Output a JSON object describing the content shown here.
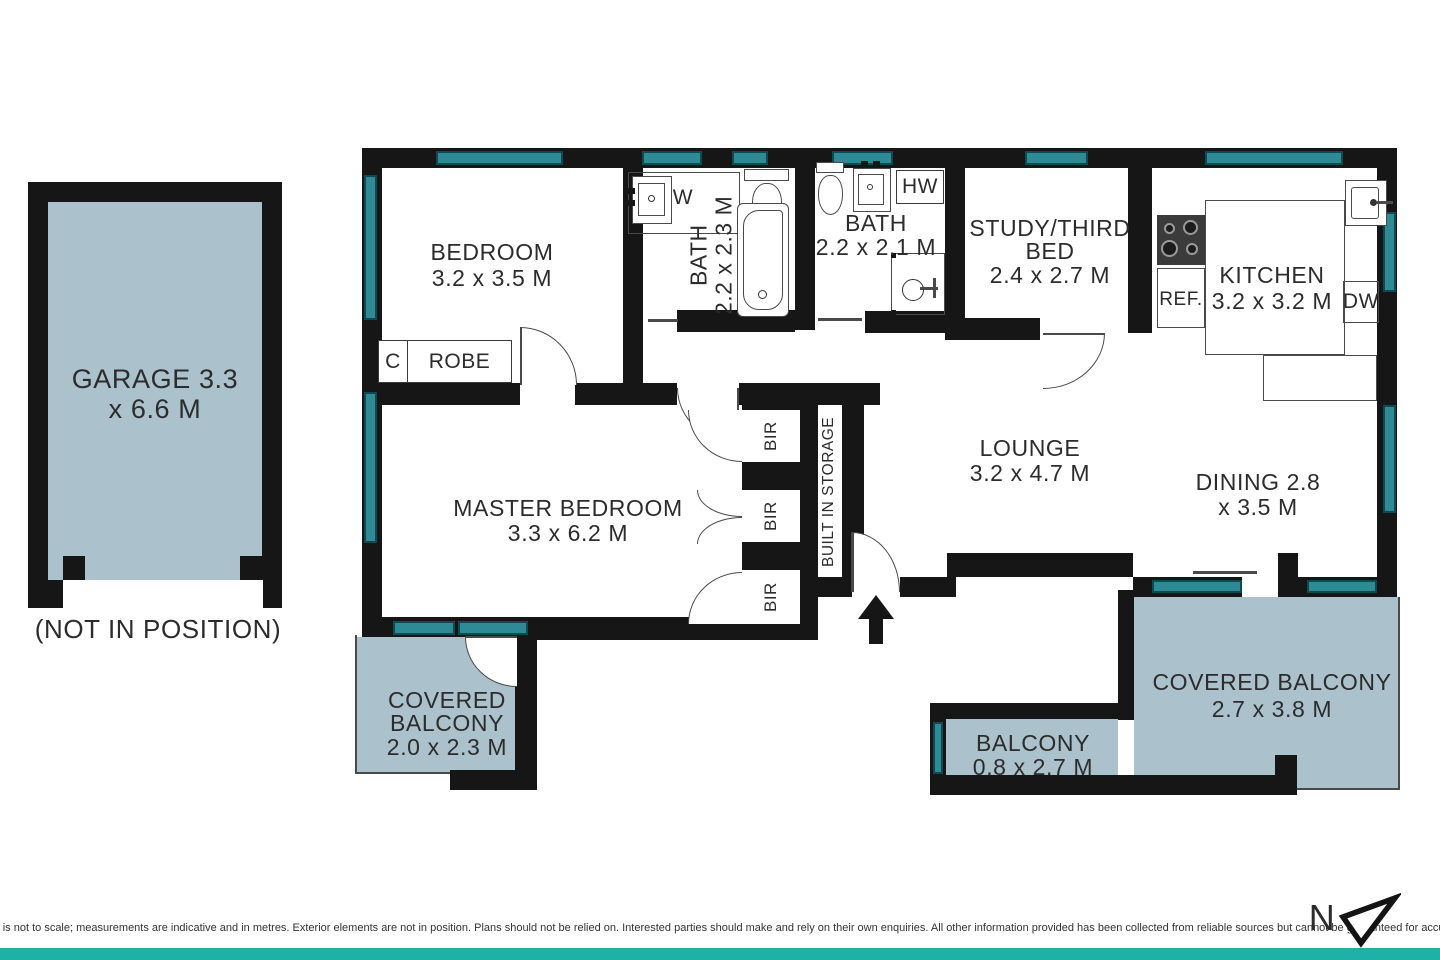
{
  "title": "Apartment floor plan",
  "colors": {
    "wall": "#161616",
    "window_teal": "#2e8a95",
    "window_border": "#0f4a52",
    "area_fill": "#abc1cb",
    "accent_bar": "#1eb2a6",
    "text": "#2c2c2c"
  },
  "garage": {
    "line1": "GARAGE 3.3",
    "line2": "x 6.6 M",
    "note": "(NOT IN POSITION)"
  },
  "rooms": {
    "bedroom": {
      "name": "BEDROOM",
      "dims": "3.2 x 3.5 M"
    },
    "bath1": {
      "name": "BATH",
      "dims": "2.2 x 2.3 M"
    },
    "bath2": {
      "name": "BATH",
      "dims": "2.2 x 2.1 M"
    },
    "study": {
      "line1": "STUDY/THIRD",
      "line2": "BED",
      "dims": "2.4 x 2.7 M"
    },
    "kitchen": {
      "name": "KITCHEN",
      "dims": "3.2 x 3.2 M"
    },
    "master": {
      "name": "MASTER BEDROOM",
      "dims": "3.3 x 6.2 M"
    },
    "lounge": {
      "name": "LOUNGE",
      "dims": "3.2 x 4.7 M"
    },
    "dining": {
      "line1": "DINING 2.8",
      "line2": "x 3.5 M"
    },
    "covered_balcony_left": {
      "line1": "COVERED",
      "line2": "BALCONY",
      "dims": "2.0 x 2.3 M"
    },
    "balcony": {
      "name": "BALCONY",
      "dims": "0.8 x 2.7 M"
    },
    "covered_balcony_right": {
      "name": "COVERED BALCONY",
      "dims": "2.7 x 3.8 M"
    }
  },
  "fixtures": {
    "cupboard": "C",
    "robe": "ROBE",
    "bir": [
      "BIR",
      "BIR",
      "BIR"
    ],
    "built_in_storage": "BUILT IN STORAGE",
    "washer": "W",
    "hot_water": "HW",
    "fridge": "REF.",
    "dishwasher": "DW"
  },
  "compass": {
    "north_label": "N"
  },
  "footer": {
    "disclaimer": "The floor plan is not to scale; measurements are indicative and in metres. Exterior elements are not in position. Plans should not be relied on. Interested parties should make and rely on their own enquiries. All other information provided has been collected from reliable sources but cannot be guaranteed for accuracy."
  }
}
